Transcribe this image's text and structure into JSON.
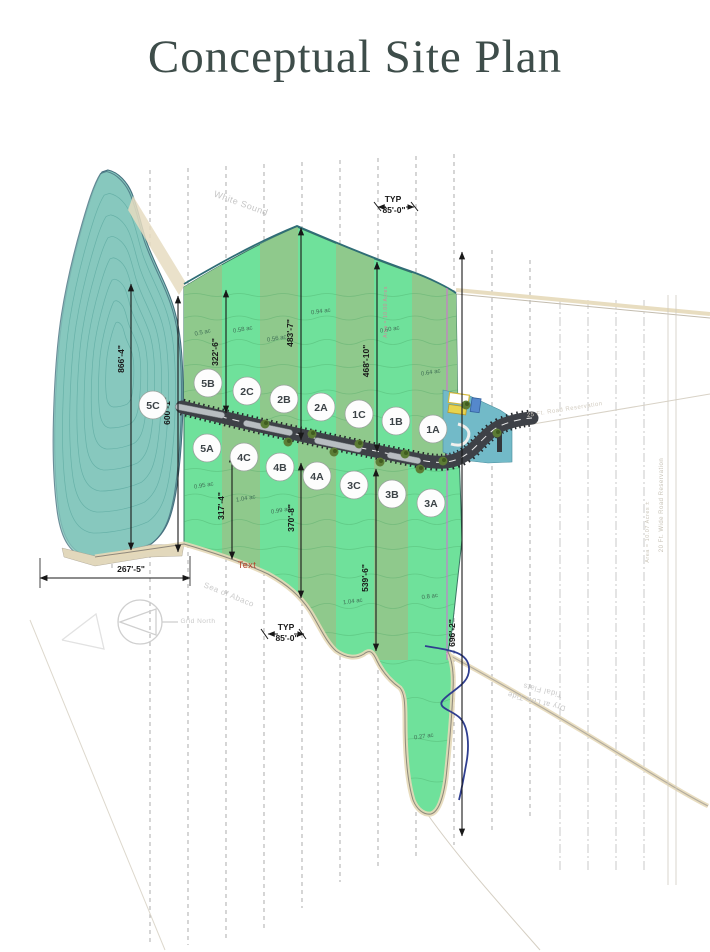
{
  "title": "Conceptual Site Plan",
  "colors": {
    "title_text": "#3e4d4a",
    "water": "#87c8be",
    "bright_lot_green": "#6fe19b",
    "sage_lot_green": "#8fc98c",
    "road": "#3e4147",
    "entrance_water": "#72bac8",
    "dimension_text": "#181818",
    "acreage_text": "#3f6e55",
    "faint_survey_text": "#c9c9c9",
    "magenta_line": "#d66bd6",
    "stream_line": "#2f3e8f"
  },
  "plan": {
    "lots": [
      {
        "id": "5C",
        "x": 153,
        "y": 405
      },
      {
        "id": "5B",
        "x": 208,
        "y": 383
      },
      {
        "id": "2C",
        "x": 247,
        "y": 391
      },
      {
        "id": "2B",
        "x": 284,
        "y": 399
      },
      {
        "id": "2A",
        "x": 321,
        "y": 407
      },
      {
        "id": "1C",
        "x": 359,
        "y": 414
      },
      {
        "id": "1B",
        "x": 396,
        "y": 421
      },
      {
        "id": "1A",
        "x": 433,
        "y": 429
      },
      {
        "id": "5A",
        "x": 207,
        "y": 448
      },
      {
        "id": "4C",
        "x": 244,
        "y": 457
      },
      {
        "id": "4B",
        "x": 280,
        "y": 467
      },
      {
        "id": "4A",
        "x": 317,
        "y": 476
      },
      {
        "id": "3C",
        "x": 354,
        "y": 485
      },
      {
        "id": "3B",
        "x": 392,
        "y": 494
      },
      {
        "id": "3A",
        "x": 431,
        "y": 503
      }
    ],
    "acreages": [
      {
        "text": "0.5 ac",
        "x": 203,
        "y": 334,
        "rot": -12
      },
      {
        "text": "0.58 ac",
        "x": 243,
        "y": 331,
        "rot": -10
      },
      {
        "text": "0.56 ac",
        "x": 277,
        "y": 340,
        "rot": -10
      },
      {
        "text": "0.94 ac",
        "x": 321,
        "y": 313,
        "rot": -8
      },
      {
        "text": "0.60 ac",
        "x": 390,
        "y": 331,
        "rot": -10
      },
      {
        "text": "0.64 ac",
        "x": 431,
        "y": 374,
        "rot": -10
      },
      {
        "text": "0.95 ac",
        "x": 204,
        "y": 487,
        "rot": -10
      },
      {
        "text": "1.04 ac",
        "x": 246,
        "y": 500,
        "rot": -10
      },
      {
        "text": "0.99 ac",
        "x": 281,
        "y": 512,
        "rot": -10
      },
      {
        "text": "1.04 ac",
        "x": 353,
        "y": 603,
        "rot": -8
      },
      {
        "text": "0.8 ac",
        "x": 430,
        "y": 598,
        "rot": -8
      },
      {
        "text": "0.27 ac",
        "x": 424,
        "y": 738,
        "rot": -8
      }
    ],
    "dimensions": [
      {
        "text": "866'-4\"",
        "tx": 124,
        "ty": 359,
        "rot": -90,
        "x1": 131,
        "y1": 284,
        "x2": 131,
        "y2": 550
      },
      {
        "text": "600'-1\"",
        "tx": 170,
        "ty": 411,
        "rot": -90,
        "x1": 178,
        "y1": 296,
        "x2": 178,
        "y2": 552
      },
      {
        "text": "322'-6\"",
        "tx": 218,
        "ty": 352,
        "rot": -90,
        "x1": 226,
        "y1": 290,
        "x2": 226,
        "y2": 413
      },
      {
        "text": "483'-7\"",
        "tx": 293,
        "ty": 333,
        "rot": -90,
        "x1": 301,
        "y1": 228,
        "x2": 301,
        "y2": 440
      },
      {
        "text": "468'-10\"",
        "tx": 369,
        "ty": 361,
        "rot": -90,
        "x1": 377,
        "y1": 262,
        "x2": 377,
        "y2": 452
      },
      {
        "text": "317'-4\"",
        "tx": 224,
        "ty": 506,
        "rot": -90,
        "x1": 232,
        "y1": 455,
        "x2": 232,
        "y2": 559
      },
      {
        "text": "370'-8\"",
        "tx": 294,
        "ty": 518,
        "rot": -90,
        "x1": 301,
        "y1": 463,
        "x2": 301,
        "y2": 598
      },
      {
        "text": "539'-6\"",
        "tx": 368,
        "ty": 578,
        "rot": -90,
        "x1": 376,
        "y1": 469,
        "x2": 376,
        "y2": 651
      },
      {
        "text": "696'-2\"",
        "tx": 455,
        "ty": 633,
        "rot": -90,
        "x1": 462,
        "y1": 252,
        "x2": 462,
        "y2": 836
      },
      {
        "text": "267'-5\"",
        "tx": 131,
        "ty": 572,
        "rot": 0,
        "x1": 40,
        "y1": 578,
        "x2": 190,
        "y2": 578
      }
    ],
    "typ_callouts": [
      {
        "line1": "TYP",
        "line2": "85'-0\"",
        "x": 393,
        "y": 202
      },
      {
        "line1": "TYP",
        "line2": "85'-0\"",
        "x": 286,
        "y": 630
      }
    ],
    "annotations": [
      {
        "text": "White Sound",
        "x": 240,
        "y": 206,
        "rot": 20,
        "size": 9,
        "color": "#c6c6c6"
      },
      {
        "text": "Sea of Abaco",
        "x": 228,
        "y": 597,
        "rot": 22,
        "size": 8,
        "color": "#cbcbcb"
      },
      {
        "text": "Grid North",
        "x": 198,
        "y": 623,
        "rot": 0,
        "size": 6.5,
        "color": "#c9c9c9"
      },
      {
        "text": "25 Ft. Road Reservation",
        "x": 565,
        "y": 411,
        "rot": -9,
        "size": 6,
        "color": "#d2ccc0"
      },
      {
        "text": "20 Ft. Wide Road Reservation",
        "x": 663,
        "y": 505,
        "rot": -90,
        "size": 6,
        "color": "#c7c2b6"
      },
      {
        "text": "Area = 10.07 Acres ±",
        "x": 649,
        "y": 532,
        "rot": -90,
        "size": 5.5,
        "color": "#ccc7bb"
      },
      {
        "text": "Area = 10.00 Acres",
        "x": 387,
        "y": 312,
        "rot": -90,
        "size": 5,
        "color": "#d08898"
      },
      {
        "text": "Tidal Flats",
        "x": 543,
        "y": 688,
        "rot": 194,
        "size": 7.5,
        "color": "#c9c9c9"
      },
      {
        "text": "Dry at Low Tide",
        "x": 537,
        "y": 699,
        "rot": 194,
        "size": 7.5,
        "color": "#c9c9c9"
      },
      {
        "text": "Text",
        "x": 247,
        "y": 568,
        "rot": 0,
        "size": 9,
        "color": "#b2442c"
      }
    ]
  }
}
